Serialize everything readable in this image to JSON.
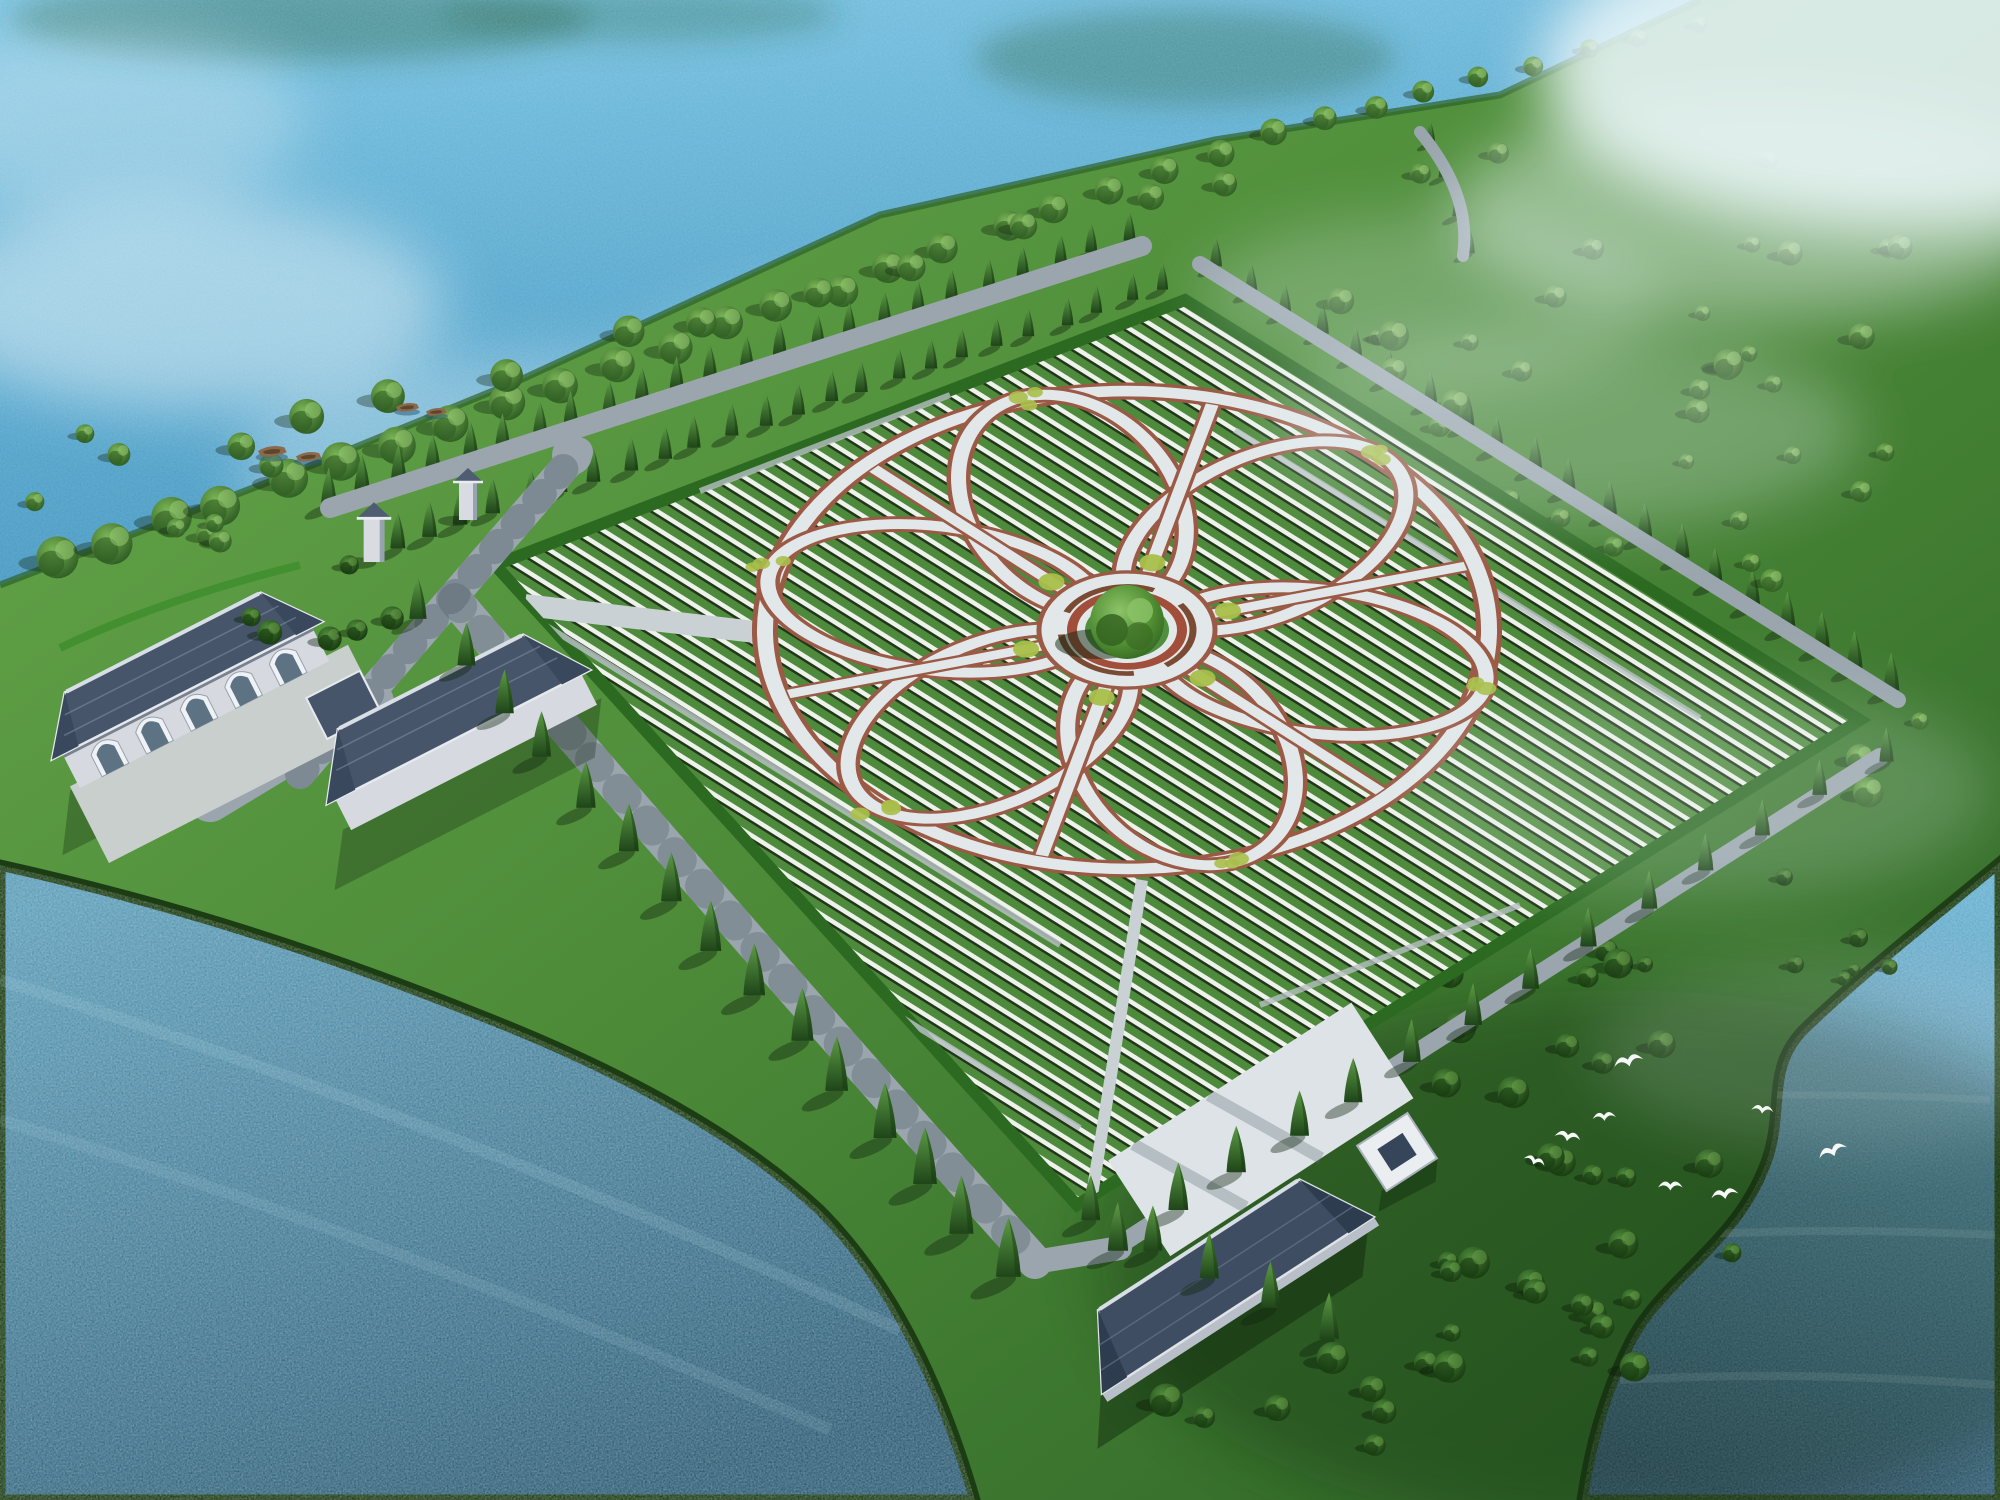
{
  "meta": {
    "title": "Lakeside memorial park master plan - aerial rendering",
    "description": "3D bird's-eye architectural rendering of a cemetery park on a lake peninsula: a large rhombic burial field of dense headstone rows with a six-petal flower-shaped pathway system around a central circular plaza with one large tree; cypress-lined perimeter roads, entrance gate towers, three tile-roof service buildings, a small white pavilion, two wooden boats on the upper lake, scattered tree meadows to the east, white cranes flying over the dark south-east lawn, and mist over the upper-right corner."
  },
  "scene": {
    "colors": {
      "waterTop1": "#7cc4e2",
      "waterTop2": "#55a6cd",
      "waterTop3": "#4493bd",
      "waterBL1": "#5a9cb8",
      "waterBL2": "#2b5b74",
      "waterBR1": "#66b0d0",
      "waterBR2": "#284f68",
      "coastHedge": "#1c3d14",
      "shoreEdge": "#2e6327",
      "land1": "#69aa4c",
      "land2": "#4c8a38",
      "land3": "#2b6125",
      "cloud": "#eaf6fa",
      "mist": "#e8f4f7",
      "treeReflection": "#2f6d52",
      "fieldHedgerow": "#4e8a3b",
      "fieldRowWhite": "#edf2ea",
      "fieldRowShadow": "#22361b",
      "fieldBorder": "#2c6a21",
      "paving": "#e2e8e9",
      "pavingDim": "#c9d1d4",
      "pathEdge": "#9b5a45",
      "plazaRing": "#a14e3a",
      "bench": "#7b4a32",
      "plazaGreen": "#4f8f3f",
      "shrubYellow": "#a8bf4a",
      "road": "#9aa5ad",
      "roadShadow": "#4a5a64",
      "roofDark": "#46556a",
      "roofDarker": "#3e4d61",
      "roofRidge": "#d8dee6",
      "wall": "#d6d9df",
      "wallShade": "#78828f",
      "court": "#c9cfcc",
      "glass": "#5d7384",
      "archTrim": "#eef2f5",
      "cypress1": "#5c9c46",
      "cypress2": "#1f4519",
      "tree1": "#79b455",
      "tree2": "#2c5a21",
      "treeDark1": "#4f8a3b",
      "treeDark2": "#16380f",
      "boat": "#8a6a4a",
      "boatDark": "#5f452c",
      "bird": "#f7faf7",
      "shadow": "#12260f"
    },
    "field": {
      "polygon": [
        [
          1185,
          300
        ],
        [
          1860,
          720
        ],
        [
          1077,
          1205
        ],
        [
          495,
          565
        ]
      ]
    },
    "flower": {
      "cx": 1127,
      "cy": 630,
      "rot": -16,
      "squash": 0.66,
      "ringR": 362,
      "petalCount": 6,
      "petalCy": -198,
      "petalRx": 108,
      "petalRy": 170,
      "spokeR1": 70,
      "spokeR2": 352,
      "plazaR": 88,
      "ringInnerR": 55,
      "greenR": 42,
      "benchR": 66
    },
    "tree_lines": [
      {
        "sym": "symTree",
        "x1": 60,
        "y1": 560,
        "x2": 1280,
        "y2": 132,
        "n": 23,
        "s1": 1.5,
        "s2": 0.95,
        "jit": 14,
        "seed": 2,
        "layer": "back",
        "name": "shore-tree-row"
      },
      {
        "sym": "symTree",
        "x1": 1320,
        "y1": 118,
        "x2": 1695,
        "y2": 24,
        "n": 8,
        "s1": 0.85,
        "s2": 0.6,
        "jit": 10,
        "seed": 3,
        "layer": "back",
        "name": "shore-tree-row-ne"
      },
      {
        "sym": "symTree",
        "x1": 300,
        "y1": 430,
        "x2": 1240,
        "y2": 175,
        "n": 10,
        "s1": 1.25,
        "s2": 0.9,
        "jit": 46,
        "seed": 4,
        "layer": "back",
        "name": "bank-tree-row"
      },
      {
        "sym": "symCyp",
        "x1": 330,
        "y1": 505,
        "x2": 1128,
        "y2": 242,
        "n": 24,
        "s1": 1.05,
        "s2": 0.8,
        "jit": 6,
        "seed": 5,
        "layer": "back",
        "name": "cypress-row-top-outer"
      },
      {
        "sym": "symCyp",
        "x1": 395,
        "y1": 548,
        "x2": 1165,
        "y2": 290,
        "n": 24,
        "s1": 1.0,
        "s2": 0.75,
        "jit": 6,
        "seed": 6,
        "layer": "back",
        "name": "cypress-row-top-inner"
      },
      {
        "sym": "symCyp",
        "x1": 1215,
        "y1": 268,
        "x2": 1892,
        "y2": 692,
        "n": 20,
        "s1": 0.8,
        "s2": 1.05,
        "jit": 8,
        "seed": 7,
        "layer": "back",
        "name": "cypress-row-northeast"
      },
      {
        "sym": "symCyp",
        "x1": 1432,
        "y1": 142,
        "x2": 1468,
        "y2": 252,
        "n": 4,
        "s1": 0.6,
        "s2": 0.7,
        "jit": 6,
        "seed": 11,
        "layer": "back",
        "name": "cypress-row-shore-path"
      },
      {
        "sym": "symCyp",
        "x1": 420,
        "y1": 618,
        "x2": 1008,
        "y2": 1278,
        "n": 15,
        "s1": 1.15,
        "s2": 1.65,
        "jit": 10,
        "seed": 8,
        "layer": "front",
        "name": "cypress-row-southwest"
      },
      {
        "sym": "symCyp",
        "x1": 1882,
        "y1": 760,
        "x2": 1122,
        "y2": 1250,
        "n": 14,
        "s1": 0.95,
        "s2": 1.35,
        "jit": 10,
        "seed": 9,
        "layer": "front",
        "name": "cypress-row-southeast"
      },
      {
        "sym": "symCyp",
        "x1": 1090,
        "y1": 1222,
        "x2": 1332,
        "y2": 1338,
        "n": 5,
        "s1": 1.25,
        "s2": 1.3,
        "jit": 6,
        "seed": 10,
        "layer": "front",
        "name": "cypress-row-lodge"
      }
    ],
    "scatters": [
      {
        "sym": "symTree",
        "x": 1290,
        "y": 150,
        "w": 680,
        "h": 700,
        "n": 38,
        "smin": 0.55,
        "smax": 1.1,
        "seed": 21,
        "avoid": true,
        "layer": "back",
        "name": "meadow-trees-east"
      },
      {
        "sym": "symTreeDark",
        "x": 1430,
        "y": 950,
        "w": 320,
        "h": 430,
        "n": 30,
        "smin": 0.6,
        "smax": 1.25,
        "seed": 22,
        "avoid": true,
        "layer": "back",
        "name": "meadow-trees-southeast"
      },
      {
        "sym": "symTreeDark",
        "x": 1750,
        "y": 870,
        "w": 170,
        "h": 120,
        "n": 6,
        "smin": 0.5,
        "smax": 0.8,
        "seed": 23,
        "avoid": false,
        "layer": "back",
        "name": "coast-trees"
      },
      {
        "sym": "symTree",
        "x": 30,
        "y": 430,
        "w": 280,
        "h": 115,
        "n": 9,
        "smin": 0.6,
        "smax": 1.0,
        "seed": 24,
        "avoid": false,
        "layer": "back",
        "name": "west-strip-trees"
      },
      {
        "sym": "symTreeDark",
        "x": 225,
        "y": 555,
        "w": 200,
        "h": 95,
        "n": 6,
        "smin": 0.7,
        "smax": 1.1,
        "seed": 25,
        "avoid": false,
        "layer": "front",
        "name": "entrance-grove"
      },
      {
        "sym": "symTreeDark",
        "x": 1140,
        "y": 1355,
        "w": 350,
        "h": 110,
        "n": 9,
        "smin": 0.8,
        "smax": 1.3,
        "seed": 26,
        "avoid": false,
        "layer": "front",
        "name": "south-grove"
      }
    ],
    "birds": [
      {
        "x": 1612,
        "y": 1058,
        "s": 1.15,
        "r": -15
      },
      {
        "x": 1556,
        "y": 1128,
        "s": 1.0,
        "r": 10
      },
      {
        "x": 1592,
        "y": 1112,
        "s": 0.9,
        "r": -5
      },
      {
        "x": 1526,
        "y": 1152,
        "s": 0.85,
        "r": 20
      },
      {
        "x": 1658,
        "y": 1180,
        "s": 0.95,
        "r": 0
      },
      {
        "x": 1710,
        "y": 1190,
        "s": 1.05,
        "r": -10
      },
      {
        "x": 1752,
        "y": 1103,
        "s": 0.85,
        "r": 6
      },
      {
        "x": 1816,
        "y": 1150,
        "s": 1.15,
        "r": -22
      }
    ],
    "boats": [
      {
        "x": 258,
        "y": 446,
        "s": 1.25
      },
      {
        "x": 296,
        "y": 452,
        "s": 1.1
      },
      {
        "x": 396,
        "y": 403,
        "s": 1.0
      },
      {
        "x": 426,
        "y": 408,
        "s": 0.9
      }
    ],
    "gates": [
      {
        "x": 374,
        "y": 562,
        "s": 1.15
      },
      {
        "x": 468,
        "y": 520,
        "s": 1.0
      }
    ]
  }
}
